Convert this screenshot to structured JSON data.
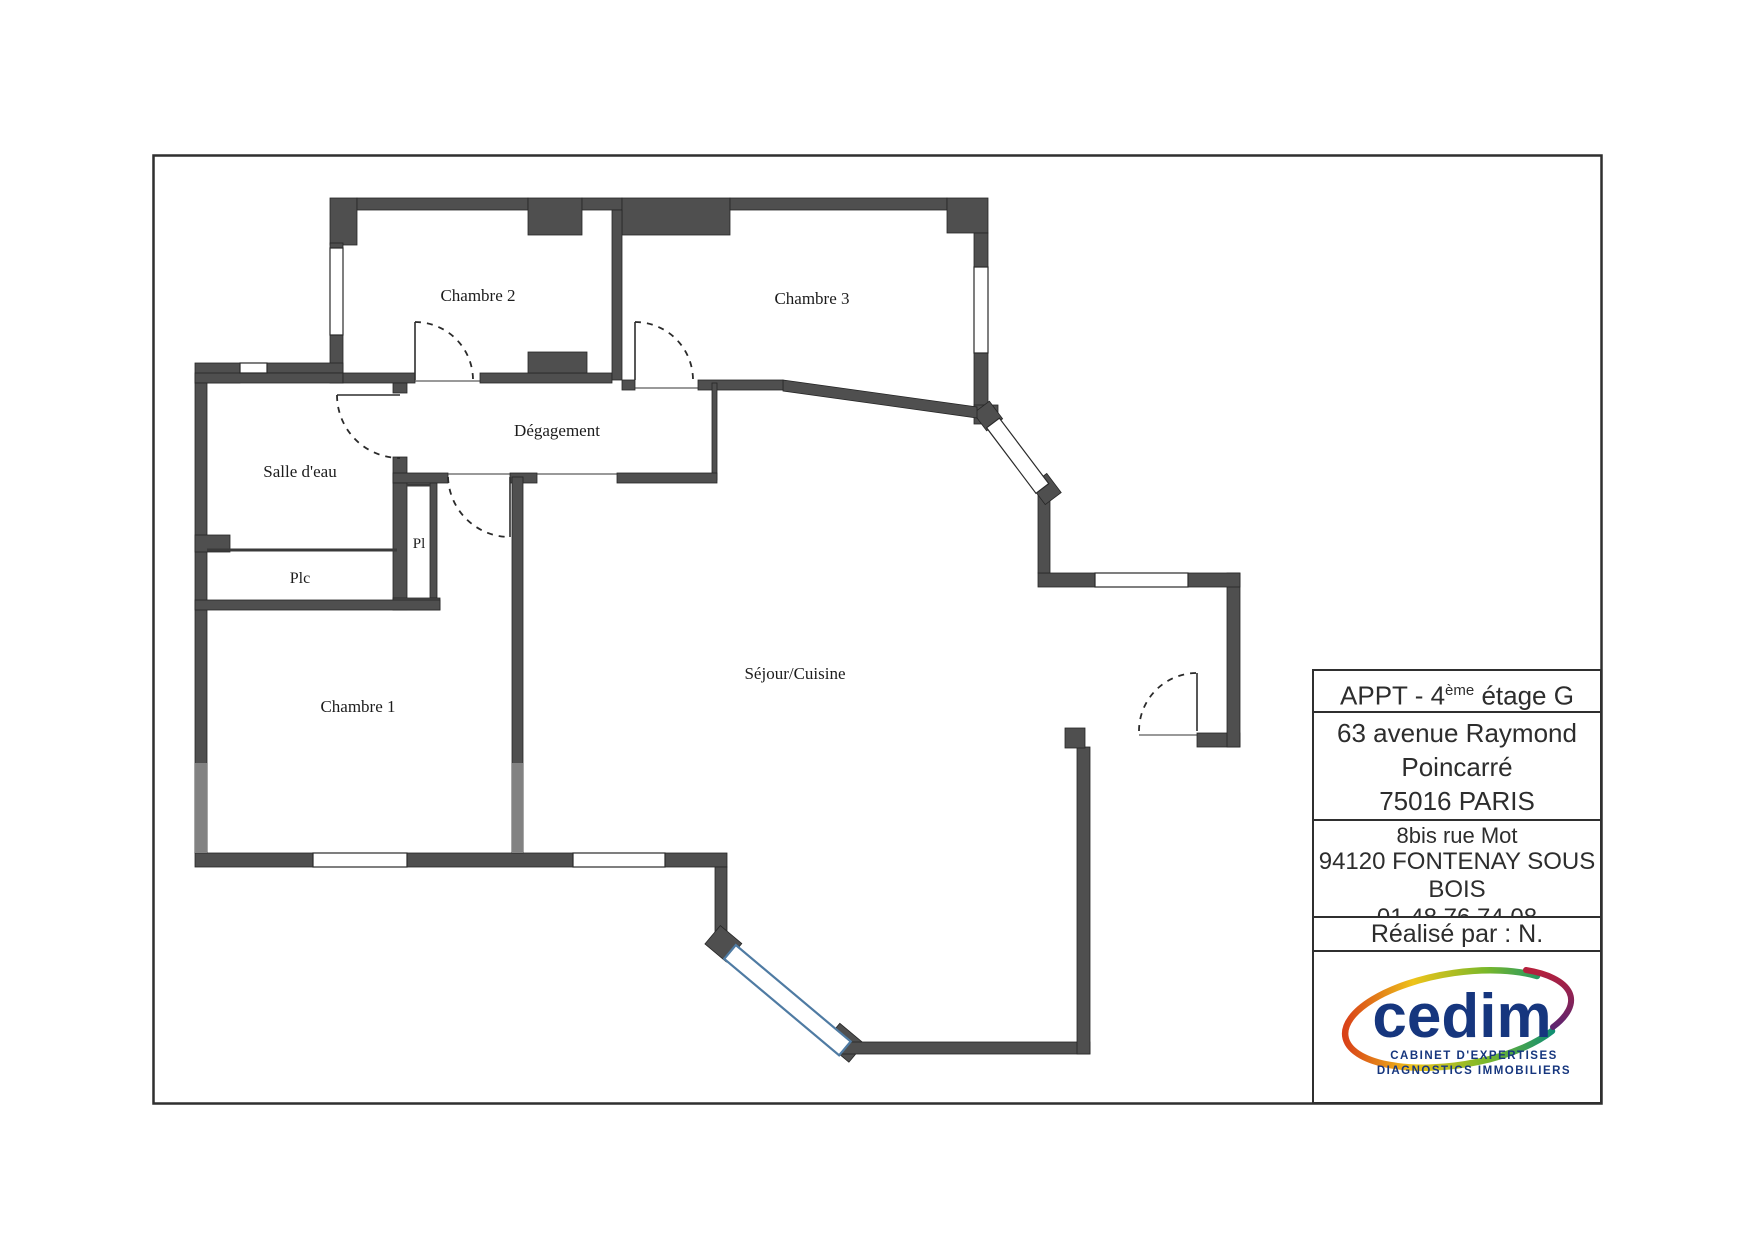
{
  "page": {
    "background": "#ffffff",
    "border_color": "#2f2f2f",
    "wall_color": "#4f4f4f",
    "wall_light_color": "#828282",
    "bay_window_color": "#4f7ba3"
  },
  "floor_plan": {
    "rooms": [
      {
        "id": "chambre2",
        "label": "Chambre 2"
      },
      {
        "id": "chambre3",
        "label": "Chambre 3"
      },
      {
        "id": "salle_deau",
        "label": "Salle d'eau"
      },
      {
        "id": "degagement",
        "label": "Dégagement"
      },
      {
        "id": "pl",
        "label": "Pl"
      },
      {
        "id": "plc",
        "label": "Plc"
      },
      {
        "id": "chambre1",
        "label": "Chambre 1"
      },
      {
        "id": "sejour",
        "label": "Séjour/Cuisine"
      }
    ]
  },
  "title_block": {
    "apt": {
      "prefix": "APPT - 4",
      "sup": "ème",
      "suffix": " étage G"
    },
    "address_line1": "63 avenue Raymond",
    "address_line2": "Poincarré",
    "address_line3": "75016 PARIS",
    "office_line1": "8bis rue Mot",
    "office_line2": "94120 FONTENAY SOUS BOIS",
    "office_line3": "01 48 76 74 08",
    "office_note": "Réalisation tout diagnostic immobilier",
    "author": "Réalisé par : N. CONSOLIN"
  },
  "logo": {
    "name": "cedim",
    "caption_line1": "CABINET D'EXPERTISES",
    "caption_line2": "DIAGNOSTICS IMMOBILIERS",
    "text_color": "#16367e"
  }
}
